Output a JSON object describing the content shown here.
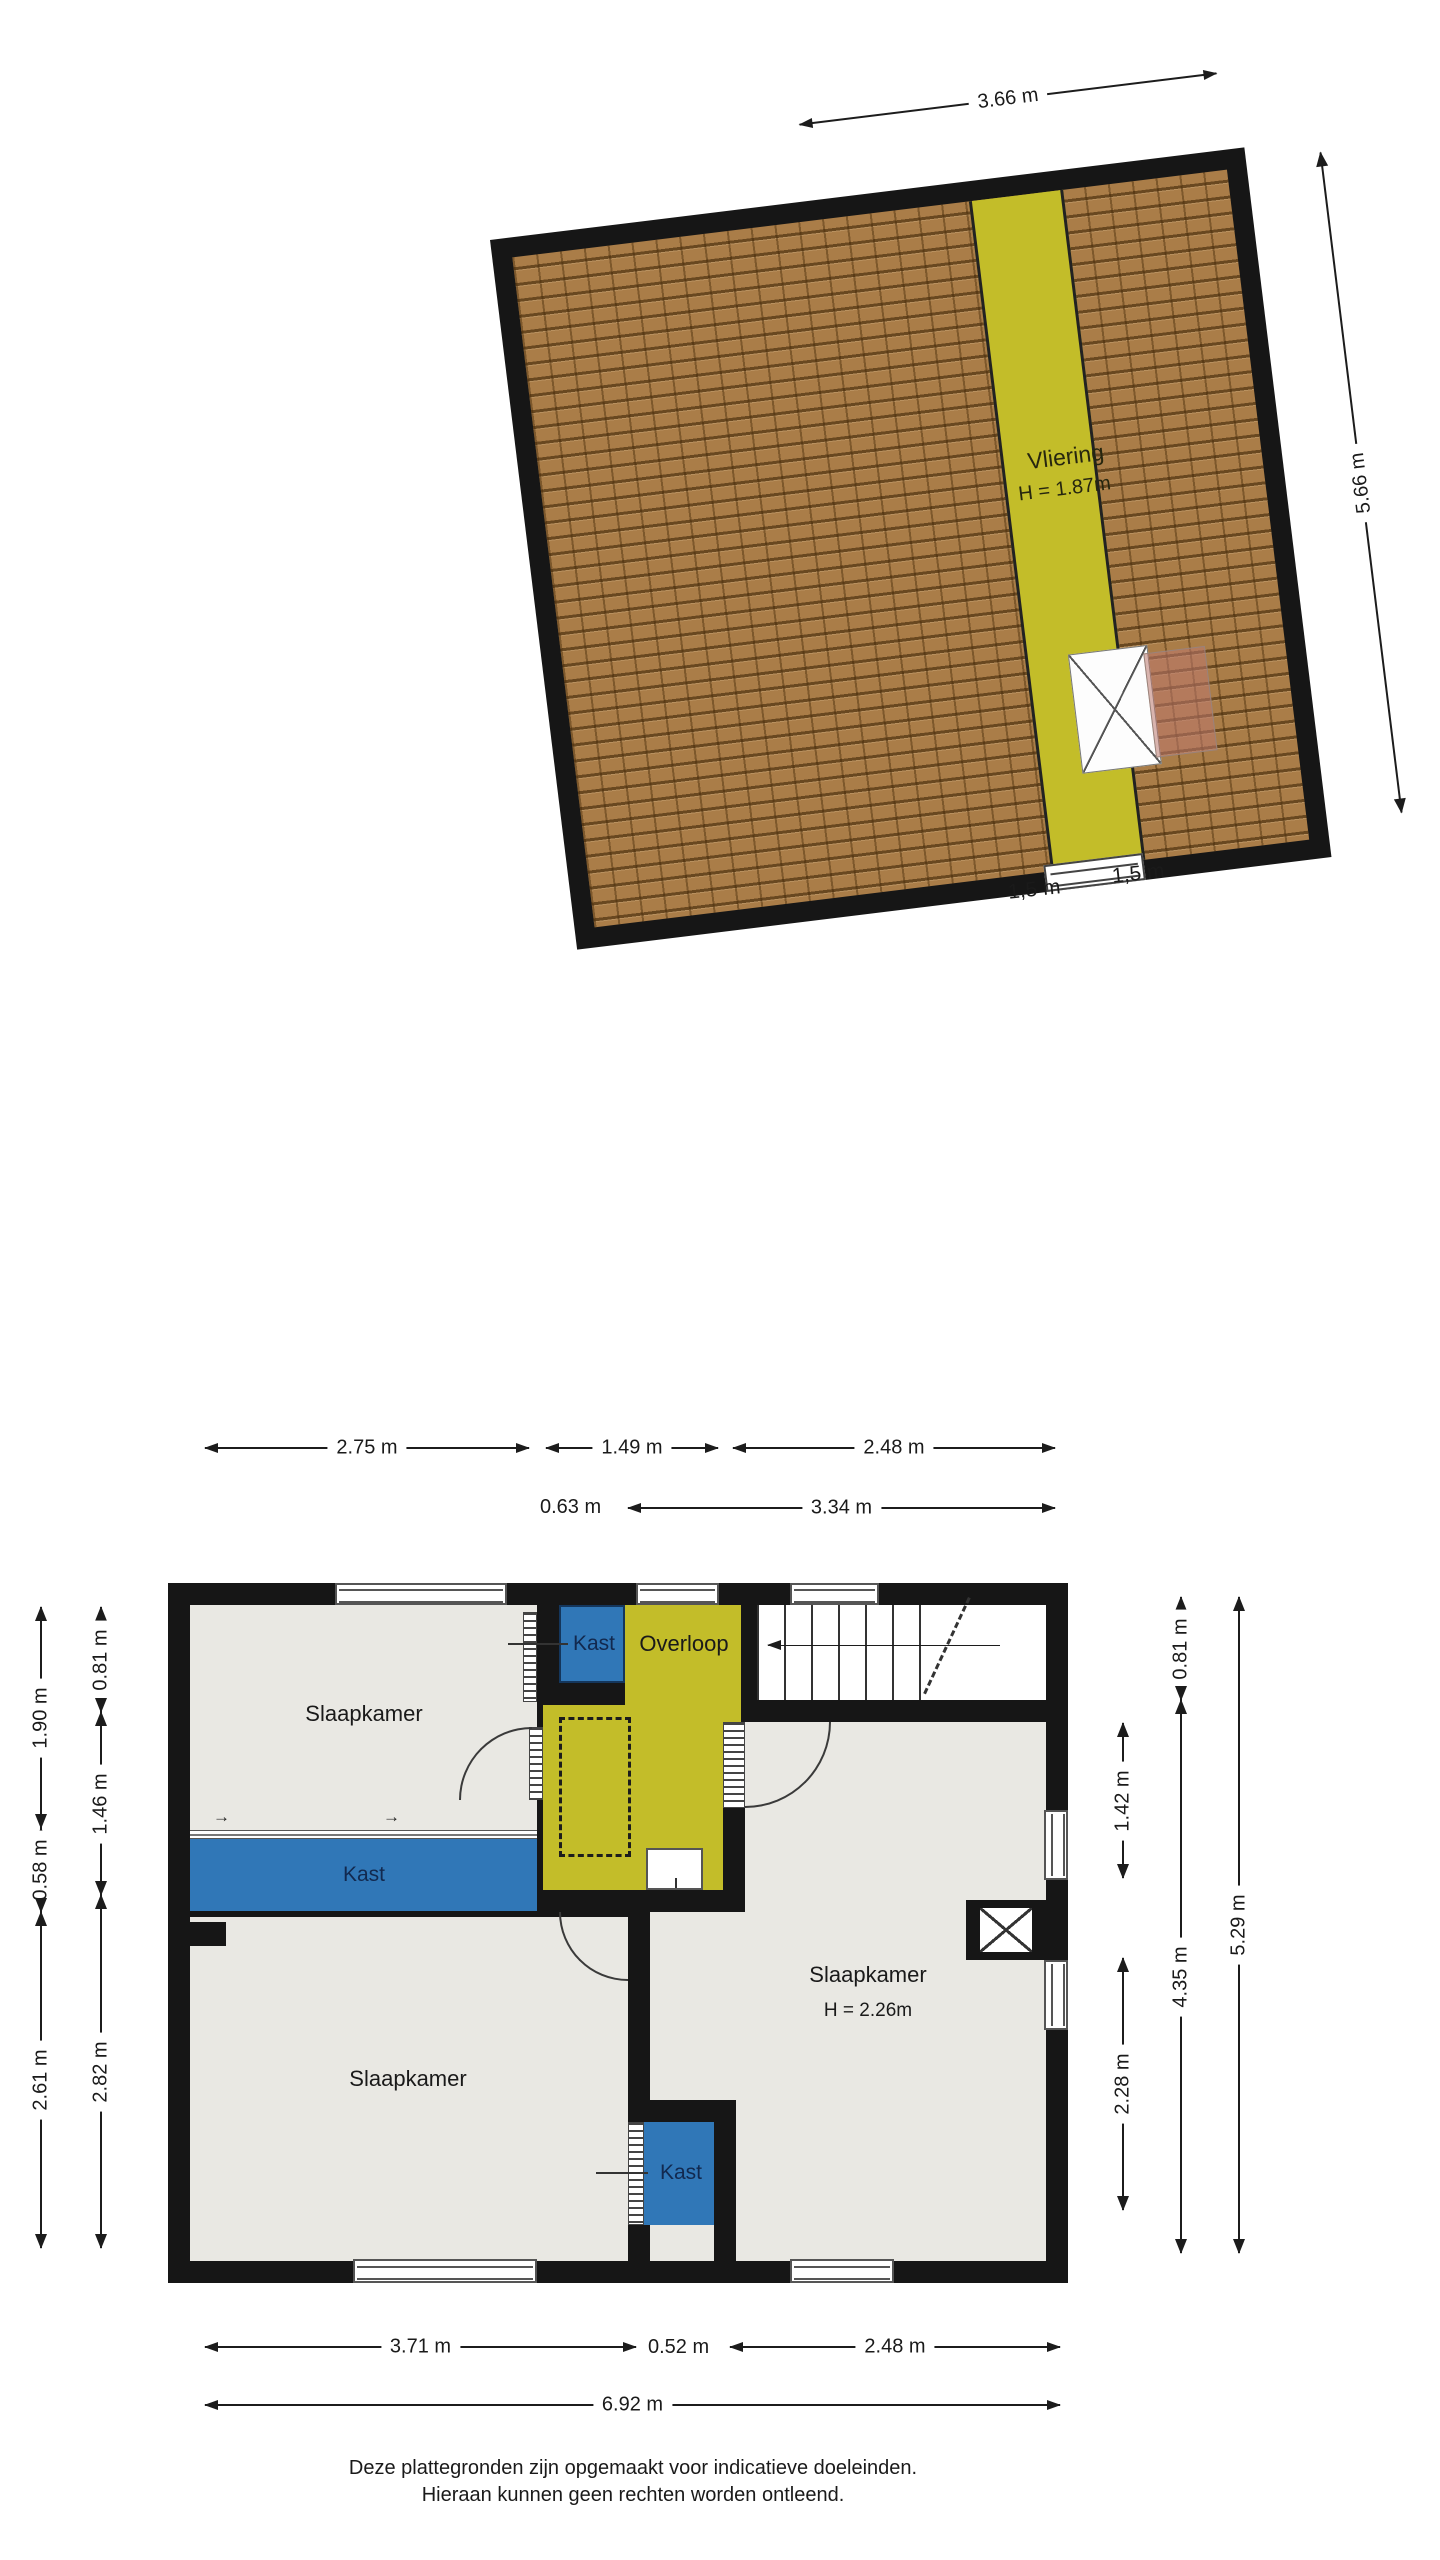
{
  "roof_plan": {
    "room_label": "Vliering",
    "room_height_label": "H = 1.87m",
    "dim_top": "3.66 m",
    "dim_right": "5.66 m",
    "dims_bottom": [
      "1,5 m",
      "1,5 m"
    ]
  },
  "floor_plan": {
    "rooms": {
      "bedroom_top_left": "Slaapkamer",
      "closet_top": "Kast",
      "landing": "Overloop",
      "closet_strip": "Kast",
      "bedroom_bottom_left": "Slaapkamer",
      "bedroom_right": "Slaapkamer",
      "bedroom_right_height": "H = 2.26m",
      "closet_bottom": "Kast"
    },
    "symbols": {
      "sliding_arrow": "→"
    },
    "dims": {
      "top_row1": [
        "2.75 m",
        "1.49 m",
        "2.48 m"
      ],
      "top_row2": [
        "0.63 m",
        "3.34 m"
      ],
      "left_outer": [
        "1.90 m",
        "0.58 m",
        "2.61 m"
      ],
      "left_inner": [
        "0.81 m",
        "1.46 m",
        "2.82 m"
      ],
      "right_inner": [
        "1.42 m",
        "2.28 m"
      ],
      "right_mid": [
        "0.81 m",
        "4.35 m"
      ],
      "right_outer": [
        "5.29 m"
      ],
      "bottom_row1": [
        "3.71 m",
        "0.52 m",
        "2.48 m"
      ],
      "bottom_row2": [
        "6.92 m"
      ]
    }
  },
  "footer": {
    "line1": "Deze plattegronden zijn opgemaakt voor indicatieve doeleinden.",
    "line2": "Hieraan kunnen geen rechten worden ontleend."
  },
  "colors": {
    "wall": "#161616",
    "floor": "#e9e8e3",
    "accent_yellow": "#c3bd29",
    "closet_blue": "#3077b7",
    "roof_tile": "#aa7d48",
    "dormer_pink": "rgba(188,121,109,0.55)"
  }
}
